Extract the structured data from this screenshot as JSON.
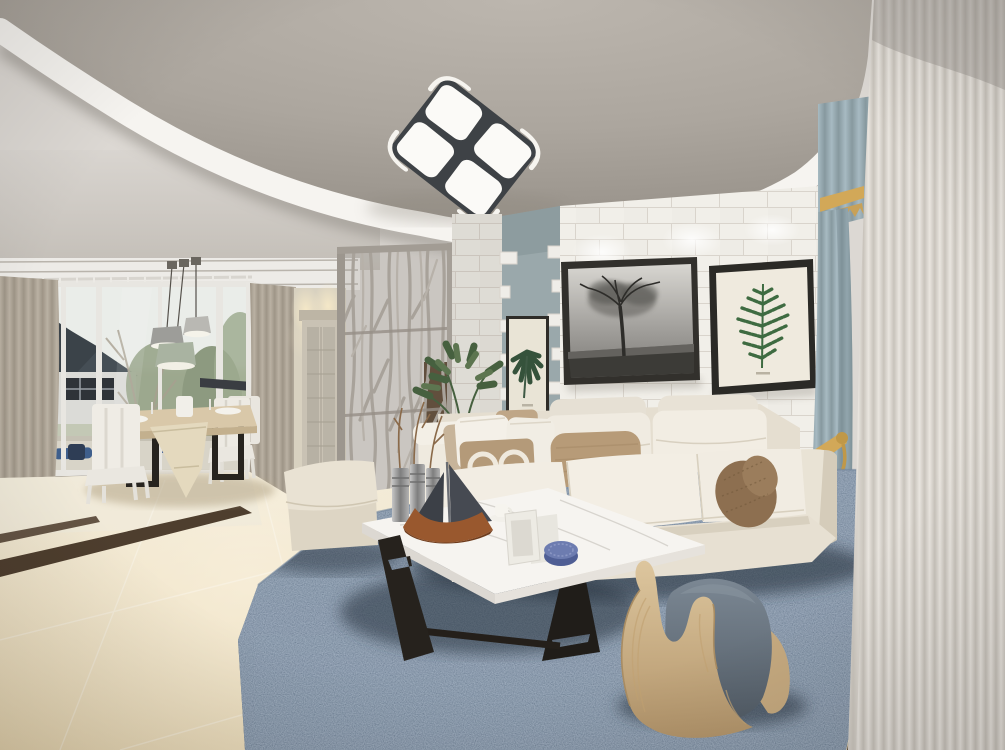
{
  "meta": {
    "description": "3D interior render of a modern Scandinavian-style living room with dining area"
  },
  "palette": {
    "ceiling_light": "#dcd8d3",
    "ceiling_panel_edge": "#a09a92",
    "band_white": "#f6f4f0",
    "band_shadow": "#8f8a83",
    "lamp_frame": "#3e4246",
    "lamp_panel": "#fbfaf7",
    "molding": "#edebe7",
    "brick": "#f1efe9",
    "mortar": "#d9d4cc",
    "accent_wall": "#9aa8ab",
    "frame_black": "#2e2c28",
    "mat_cream": "#efeade",
    "fern_green": "#3e6b41",
    "monstera_green": "#35523b",
    "photo_ground": "#3c3b37",
    "curtain_gray": "#b0a799",
    "curtain_blue": "#9db1ba",
    "gold": "#d2a858",
    "sheer": "#ddd8d1",
    "window_sky": "#e9ece9",
    "roof": "#454e55",
    "house_wall": "#dbdbd7",
    "foliage": "#98a48a",
    "balcony": "#d8d4c8",
    "navy_cushion": "#3f5f8c",
    "floor_light": "#efe9db",
    "floor_tan": "#e2d0a9",
    "floor_strip": "#4e3e2e",
    "rug_base": "#46566b",
    "rug_shadow": "#26303d",
    "sofa": "#efeadf",
    "sofa_shade": "#dcd4c5",
    "sofa_front": "#e7e0d2",
    "pillow_white": "#f4f0e8",
    "pillow_tan": "#b49a79",
    "pillow_tan2": "#c7b49a",
    "lumbar": "#b79b78",
    "bolster": "#8d6f50",
    "ottoman": "#e9e2d3",
    "table_top": "#f6f4f0",
    "table_leg": "#26221d",
    "wood_table": "#d9c8a9",
    "runner": "#e4d9be",
    "chair_white": "#edeae3",
    "boat_hull": "#99582e",
    "boat_sail": "#464a52",
    "metal_vase": "#a9a9a9",
    "plant_green": "#57714e",
    "plant_dark": "#46603f",
    "divider_gray": "#a8a29a",
    "divider_post": "#9c968e",
    "hall_wall": "#d8d1c0",
    "door_wood": "#c9c2b4",
    "threshold": "#5b4a39",
    "toy_wood": "#d3b990",
    "toy_cushion": "#616d79",
    "pendant_gray": "#9d9d99",
    "pendant_sage": "#a9b3a1",
    "pendant_light": "#b9b8b3"
  },
  "scene": {
    "objects": {
      "ceiling": "Curved recessed tray ceiling",
      "ceiling_lamp": "Four-panel square LED ceiling lamp",
      "downlights": "Recessed ceiling downlights",
      "window": "Floor-to-ceiling window of dining area",
      "house": "Neighboring house with dark gable roof",
      "curtain_left": "Gray-beige drape at window",
      "dining_set": "Wooden dining table with white chairs",
      "pendant_lamps": "Three pendant lamps over dining table",
      "hallway": "Entry hallway with mirrored door",
      "divider": "Branch-pattern metal room divider screen",
      "accent_wall": "Blue-gray accent wall panel",
      "monstera_print": "Framed monstera leaf print",
      "brick_wall": "White painted brick feature wall",
      "tree_photo": "Large black-and-white tree photograph",
      "fern_print": "Framed green fern botanical print",
      "blue_curtain": "Light blue curtain with gold valance and tieback",
      "sheer_curtain": "Floor-length sheer curtain",
      "floor": "Beige marble tile floor with dark inlay strips",
      "rug": "Mottled dark blue area rug",
      "sofa": "White fabric three-seat sofa with cushions",
      "pillows": "White and tan throw pillows",
      "bolster": "Brown cylindrical bolster pillow",
      "ottoman": "Cream upholstered ottoman",
      "coffee_table": "White marble coffee table with black legs",
      "sailboat": "Decorative model sailboat",
      "vases": "Metal cylinder vases with dried twigs",
      "photo_frames": "Small white photo frames",
      "trinket_box": "Round blue patterned box",
      "tea_cup": "White cup and saucer",
      "rocking_toy": "Bent-plywood rocking toy with gray cushion",
      "plant": "Green potted plant behind sofa"
    }
  }
}
